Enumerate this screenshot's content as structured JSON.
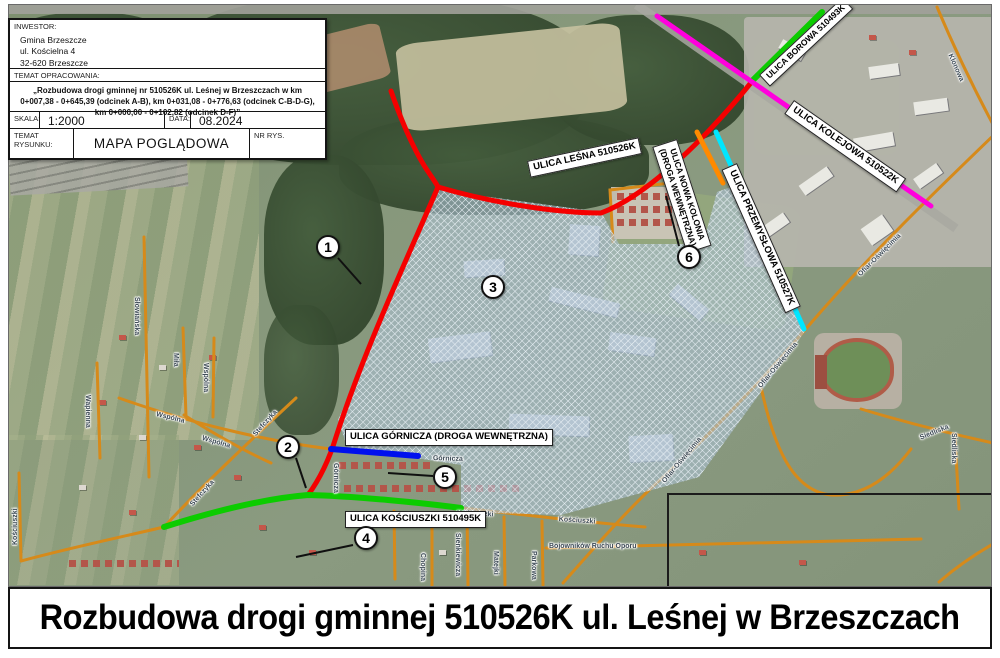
{
  "title_block": {
    "investor_label": "INWESTOR:",
    "investor_lines": [
      "Gmina Brzeszcze",
      "ul. Kościelna 4",
      "32-620 Brzeszcze"
    ],
    "subject_label": "TEMAT OPRACOWANIA:",
    "subject_text": "„Rozbudowa drogi gminnej nr 510526K ul. Leśnej w Brzeszczach w km 0+007,38 - 0+645,39 (odcinek A-B), km 0+031,08 - 0+776,63 (odcinek C-B-D-G), km 0+000,00 - 0+102,82 (odcinek D-F)”",
    "scale_label": "SKALA:",
    "scale_value": "1:2000",
    "date_label": "DATA:",
    "date_value": "08.2024",
    "drawing_label": "TEMAT RYSUNKU:",
    "drawing_value": "MAPA POGLĄDOWA",
    "number_label": "NR RYS."
  },
  "map": {
    "routes": [
      {
        "id": "lesna",
        "label": "ULICA LEŚNA 510526K",
        "color": "#f50000"
      },
      {
        "id": "borowa",
        "label": "ULICA BOROWA 510493K",
        "color": "#0ccc00"
      },
      {
        "id": "kolejowa",
        "label": "ULICA KOLEJOWA 510522K",
        "color": "#ff00dd"
      },
      {
        "id": "nowa-kolonia",
        "label": "ULICA NOWA KOLONIA",
        "label2": "(DROGA WEWNĘTRZNA)",
        "color": "#ff8a00"
      },
      {
        "id": "przemyslowa",
        "label": "ULICA PRZEMYSŁOWA 510527K",
        "color": "#00e6ff"
      },
      {
        "id": "gornicza",
        "label": "ULICA GÓRNICZA (DROGA WEWNĘTRZNA)",
        "color": "#0010ee"
      },
      {
        "id": "kosciuszki",
        "label": "ULICA KOŚCIUSZKI 510495K",
        "color": "#0ccc00"
      }
    ],
    "markers": [
      "1",
      "2",
      "3",
      "4",
      "5",
      "6"
    ],
    "streets": [
      "Słowiańska",
      "Miła",
      "Wspólna",
      "Wspólna",
      "Wspólna",
      "Wapienna",
      "Stefczyka",
      "Stefczyka",
      "Kościuszki",
      "Kościuszki",
      "Kościuszki",
      "Górnicza",
      "Górnicza",
      "Sienkiewicza",
      "Matejki",
      "Parkowa",
      "Chopina",
      "Bojowników Ruchu Oporu",
      "Ofiar-Oświęcimia",
      "Ofiar-Oświęcimia",
      "Ofiar-Oświęcimia",
      "Siedliska",
      "Siedliska",
      "Klonowa"
    ],
    "street_road_color": "#d68a1a"
  },
  "footer": {
    "title": "Rozbudowa drogi gminnej 510526K ul. Leśnej w Brzeszczach"
  }
}
